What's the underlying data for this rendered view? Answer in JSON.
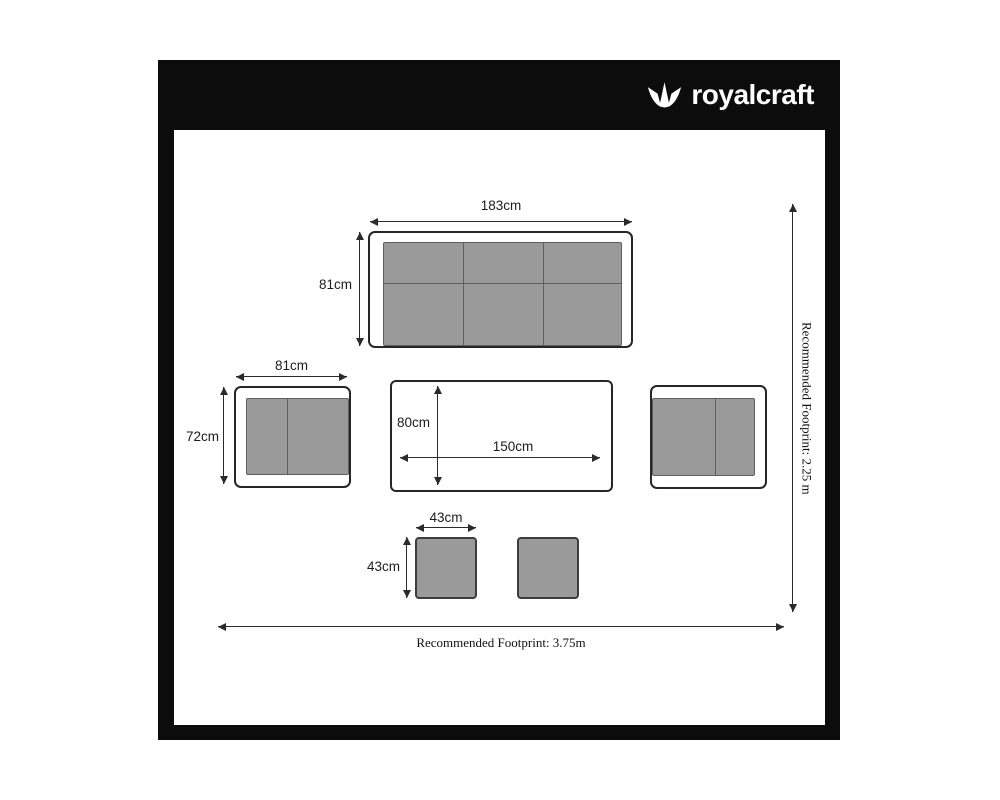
{
  "brand": {
    "name": "royalcraft",
    "icon": "crown-icon"
  },
  "furniture": {
    "sofa": {
      "width": "183cm",
      "depth": "81cm"
    },
    "armchair": {
      "width": "81cm",
      "depth": "72cm"
    },
    "table": {
      "width": "150cm",
      "depth": "80cm"
    },
    "stool": {
      "width": "43cm",
      "depth": "43cm"
    }
  },
  "footprint": {
    "width_label": "Recommended Footprint: 3.75m",
    "depth_label": "Recommended Footprint: 2.25 m"
  },
  "colors": {
    "frame": "#0c0c0c",
    "logo_text": "#ffffff",
    "cushion_fill": "#9a9a9a",
    "cushion_border": "#5f5f5f",
    "outline": "#262626"
  }
}
